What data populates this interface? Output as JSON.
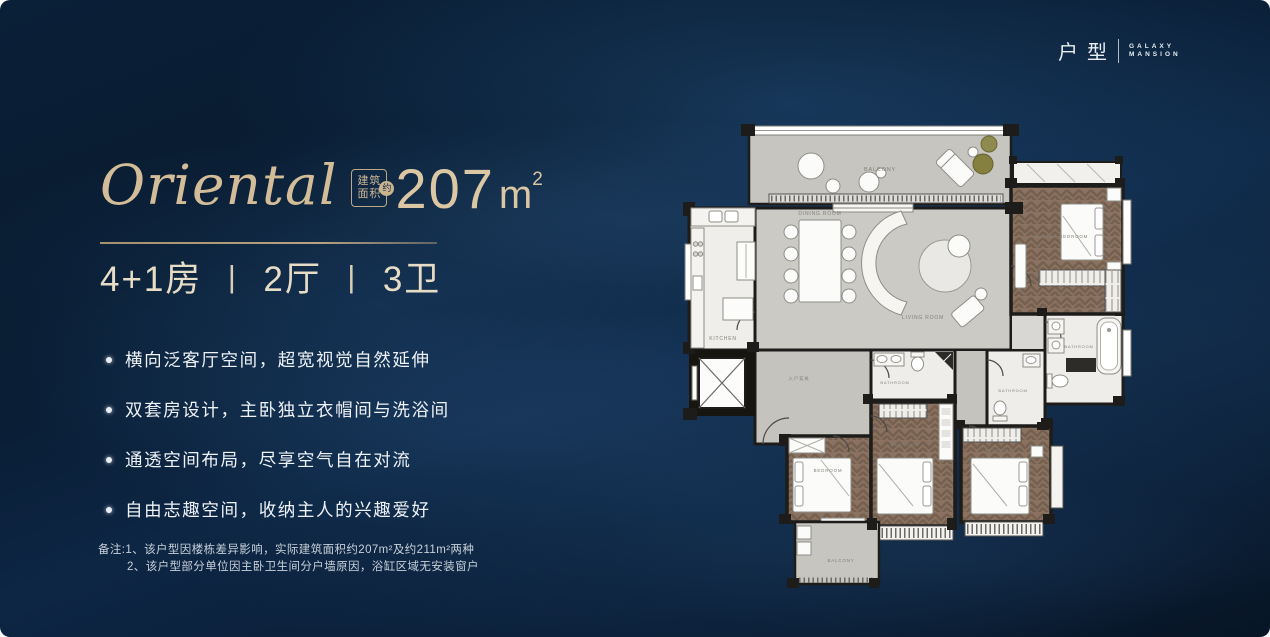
{
  "logo": {
    "cn": "户型",
    "en1": "GALAXY",
    "en2": "MANSION"
  },
  "title": {
    "name": "Oriental",
    "badge_top": "建筑",
    "badge_bottom": "面积",
    "badge_circle": "约",
    "area": "207",
    "unit": "m",
    "sup": "2"
  },
  "specs": {
    "item1": "4+1房",
    "sep": "丨",
    "item2": "2厅",
    "item3": "3卫"
  },
  "features": [
    "横向泛客厅空间，超宽视觉自然延伸",
    "双套房设计，主卧独立衣帽间与洗浴间",
    "通透空间布局，尽享空气自在对流",
    "自由志趣空间，收纳主人的兴趣爱好"
  ],
  "notes": {
    "line1": "备注:1、该户型因楼栋差异影响，实际建筑面积约207m²及约211m²两种",
    "line2": "2、该户型部分单位因主卧卫生间分户墙原因，浴缸区域无安装窗户"
  },
  "floorplan_labels": {
    "balcony_top": "BALCONY",
    "dining": "DINING ROOM",
    "living": "LIVING ROOM",
    "kitchen": "KITCHEN",
    "master_bedroom": "MASTER BEDROOM",
    "bedroom_left": "BEDROOM",
    "bedroom_mid": "BEDROOM",
    "bedroom_right": "BEDROOM",
    "bath1": "BATHROOM",
    "bath2": "BATHROOM",
    "master_bath": "BATHROOM",
    "foyer": "入户玄关",
    "balcony_bottom": "BALCONY"
  },
  "colors": {
    "accent": "#c9b28d",
    "cream": "#e7dcc6",
    "bg": "#081a2e",
    "wall": "#1d1c1a",
    "wood": "#8a7160"
  }
}
